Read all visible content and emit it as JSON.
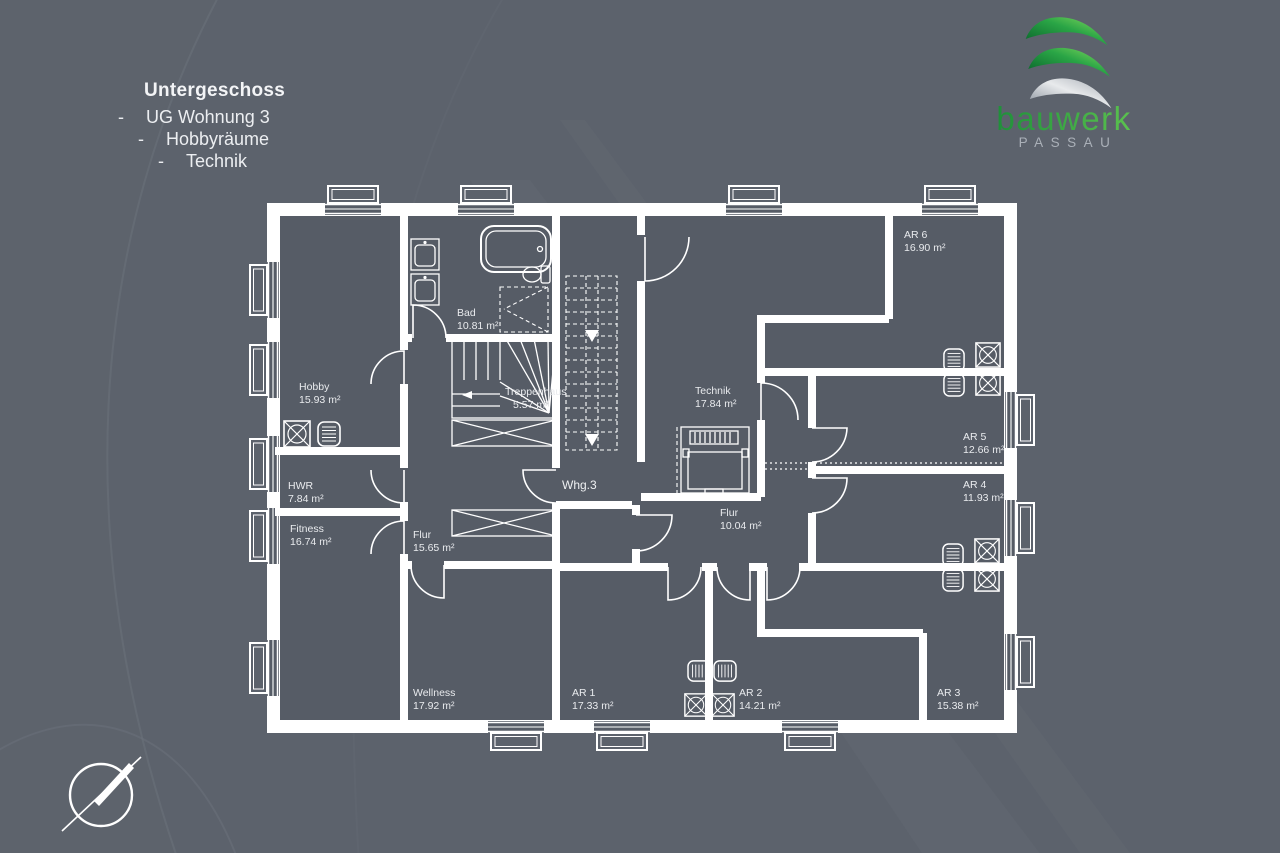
{
  "header": {
    "title": "Untergeschoss",
    "dash": "-",
    "items": [
      "UG Wohnung 3",
      "Hobbyräume",
      "Technik"
    ]
  },
  "logo": {
    "brand": "bauwerk",
    "city": "PASSAU"
  },
  "plan_type": "floor-plan",
  "rooms": [
    {
      "name": "Hobby",
      "area": "15.93 m²"
    },
    {
      "name": "Bad",
      "area": "10.81 m²"
    },
    {
      "name": "Treppenhaus",
      "area": "5.57 m²"
    },
    {
      "name": "HWR",
      "area": "7.84 m²"
    },
    {
      "name": "Fitness",
      "area": "16.74 m²"
    },
    {
      "name": "Flur",
      "area": "15.65 m²"
    },
    {
      "name": "Wellness",
      "area": "17.92 m²"
    },
    {
      "name": "Whg.3",
      "area": ""
    },
    {
      "name": "Technik",
      "area": "17.84 m²"
    },
    {
      "name": "Flur",
      "area": "10.04 m²"
    },
    {
      "name": "AR 1",
      "area": "17.33 m²"
    },
    {
      "name": "AR 2",
      "area": "14.21 m²"
    },
    {
      "name": "AR 3",
      "area": "15.38 m²"
    },
    {
      "name": "AR 4",
      "area": "11.93 m²"
    },
    {
      "name": "AR 5",
      "area": "12.66 m²"
    },
    {
      "name": "AR 6",
      "area": "16.90 m²"
    }
  ],
  "colors": {
    "background": "#5c626c",
    "room_fill": "#565c66",
    "wall": "#ffffff",
    "label": "#e9ebee",
    "logo_green_dark": "#0d6a2e",
    "logo_green_light": "#83d95d",
    "logo_silver": "#e8eaec",
    "logo_city_gray": "#aab0b8"
  }
}
